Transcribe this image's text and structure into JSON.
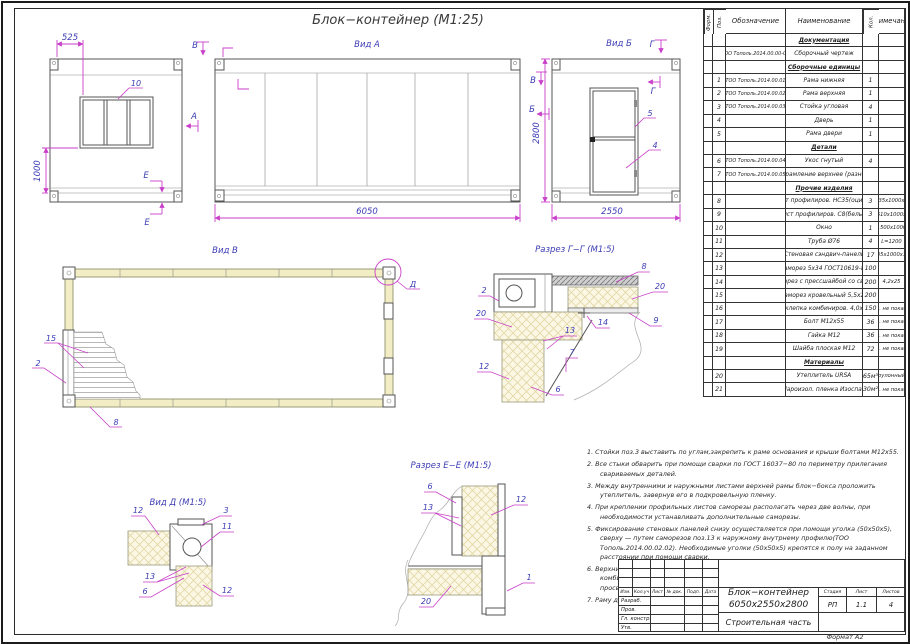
{
  "sheet": {
    "title": "Блок−контейнер  (М1:25)",
    "format": "Формат А2"
  },
  "colors": {
    "annotation_blue": "#3b3bb5",
    "dimension_magenta": "#c93fc9",
    "frame_khaki": "#f2edc4",
    "line_gray": "#555555"
  },
  "views": {
    "rear": {
      "dim_top": "525",
      "dim_left": "1000",
      "marker_top": "В",
      "marker_front": "А",
      "marker_e": "Е",
      "callouts": {
        "c10": "10"
      }
    },
    "front": {
      "title": "Вид А",
      "dim": "6050"
    },
    "end": {
      "title": "Вид Б",
      "dim_h": "2800",
      "dim_w": "2550",
      "marker_g": "Г",
      "marker_v": "В",
      "marker_b": "Б",
      "callouts": {
        "c5": "5",
        "c4": "4"
      }
    },
    "plan": {
      "title": "Вид В",
      "callouts": {
        "c15": "15",
        "c2": "2",
        "c8": "8",
        "d": "Д"
      }
    },
    "section_gg": {
      "title": "Разрез Г−Г (М1:5)",
      "callouts": {
        "c2": "2",
        "c20a": "20",
        "c8": "8",
        "c20b": "20",
        "c9": "9",
        "c14": "14",
        "c13": "13",
        "c7": "7",
        "c12": "12",
        "c6": "6"
      }
    },
    "view_d": {
      "title": "Вид Д (М1:5)",
      "callouts": {
        "c12a": "12",
        "c3": "3",
        "c11": "11",
        "c13": "13",
        "c6": "6",
        "c12b": "12"
      }
    },
    "section_ee": {
      "title": "Разрез Е−Е (М1:5)",
      "callouts": {
        "c6": "6",
        "c13": "13",
        "c12": "12",
        "c1": "1",
        "c20": "20"
      }
    }
  },
  "spec_table": {
    "headers": [
      "Форм.",
      "Поз.",
      "Обозначение",
      "Наименование",
      "Кол.",
      "Примечание"
    ],
    "rows": [
      {
        "section": "Документация"
      },
      {
        "form": "",
        "poz": "",
        "oboz": "ТОО Тополь.2014.00.00-СБ",
        "name": "Сборочный чертеж",
        "qty": "",
        "note": ""
      },
      {
        "section": "Сборочные единицы"
      },
      {
        "form": "",
        "poz": "1",
        "oboz": "ТОО Тополь.2014.00.01",
        "name": "Рама нижняя",
        "qty": "1",
        "note": ""
      },
      {
        "form": "",
        "poz": "2",
        "oboz": "ТОО Тополь.2014.00.02",
        "name": "Рама верхняя",
        "qty": "1",
        "note": ""
      },
      {
        "form": "",
        "poz": "3",
        "oboz": "ТОО Тополь.2014.00.03",
        "name": "Стойка угловая",
        "qty": "4",
        "note": ""
      },
      {
        "form": "",
        "poz": "4",
        "oboz": "",
        "name": "Дверь",
        "qty": "1",
        "note": ""
      },
      {
        "form": "",
        "poz": "5",
        "oboz": "",
        "name": "Рама двери",
        "qty": "1",
        "note": ""
      },
      {
        "section": "Детали"
      },
      {
        "form": "",
        "poz": "6",
        "oboz": "ТОО Тополь.2014.00.04",
        "name": "Укос гнутый",
        "qty": "4",
        "note": ""
      },
      {
        "form": "",
        "poz": "7",
        "oboz": "ТОО Тополь.2014.00.05",
        "name": "Обрамление верхнее (разное)",
        "qty": "",
        "note": ""
      },
      {
        "section": "Прочие изделия"
      },
      {
        "form": "",
        "poz": "8",
        "oboz": "",
        "name": "Лист профилиров. НС35(оцинк.)",
        "qty": "3",
        "note": "5935х1000х35"
      },
      {
        "form": "",
        "poz": "9",
        "oboz": "",
        "name": "Лист профилиров. С8(белый)",
        "qty": "3",
        "note": "5510х1000х8"
      },
      {
        "form": "",
        "poz": "10",
        "oboz": "",
        "name": "Окно",
        "qty": "1",
        "note": "1500х1000"
      },
      {
        "form": "",
        "poz": "11",
        "oboz": "",
        "name": "Труба Ø76",
        "qty": "4",
        "note": "L=1200"
      },
      {
        "form": "",
        "poz": "12",
        "oboz": "",
        "name": "Стеновая сэндвич-панель",
        "qty": "17",
        "note": "2435х1000х100"
      },
      {
        "form": "",
        "poz": "13",
        "oboz": "",
        "name": "Саморез 5х34 ГОСТ10619-80",
        "qty": "100",
        "note": ""
      },
      {
        "form": "",
        "poz": "14",
        "oboz": "",
        "name": "Саморез с прессшайбой со сверл.",
        "qty": "200",
        "note": "4,2х25"
      },
      {
        "form": "",
        "poz": "15",
        "oboz": "",
        "name": "Саморез кровельный 5,5х25",
        "qty": "200",
        "note": ""
      },
      {
        "form": "",
        "poz": "16",
        "oboz": "",
        "name": "Заклепка комбиниров. 4,0х12",
        "qty": "150",
        "note": "усл. не показан"
      },
      {
        "form": "",
        "poz": "17",
        "oboz": "",
        "name": "Болт М12х55",
        "qty": "36",
        "note": "усл. не показан"
      },
      {
        "form": "",
        "poz": "18",
        "oboz": "",
        "name": "Гайка М12",
        "qty": "36",
        "note": "усл. не показан"
      },
      {
        "form": "",
        "poz": "19",
        "oboz": "",
        "name": "Шайба плоская М12",
        "qty": "72",
        "note": "усл. не показан"
      },
      {
        "section": "Материалы"
      },
      {
        "form": "",
        "poz": "20",
        "oboz": "",
        "name": "Утеплитель URSA",
        "qty": "65м³",
        "note": "рулонный"
      },
      {
        "form": "",
        "poz": "21",
        "oboz": "",
        "name": "Пароизол. пленка Изоспан",
        "qty": "30м²",
        "note": "усл. не показан"
      }
    ]
  },
  "notes": [
    {
      "num": "1.",
      "text": "Стойки поз.3 выставить по углам,закрепить к раме основания и крыши болтами М12х55."
    },
    {
      "num": "2.",
      "text": "Все стыки обварить при помощи сварки по ГОСТ 16037−80 по периметру прилегания свариваемых деталей."
    },
    {
      "num": "3.",
      "text": "Между внутренними и наружными листами верхней рамы блок−бокса проложить утеплитель, завернув его в подкровельную пленку."
    },
    {
      "num": "4.",
      "text": "При креплении профильных листов саморезы располагать через две волны, при необходимости устанавливать дополнительные саморезы."
    },
    {
      "num": "5.",
      "text": "Фиксирование стеновых панелей снизу осуществляется при помощи уголка (50х50х5), сверху — путем саморезов поз.13 к наружному внутрнему профилю(ТОО Тополь.2014.00.02.02). Необходимые уголки (50х50х5) крепятся к полу на заданном расстоянии при помощи сварки."
    },
    {
      "num": "6.",
      "text": "Верхние и угловые стыки блоков закрыть соответ.обрамлением (поз 7), закрепив его комбинированными заклепками с шагом 300мм. Под заклепки предварительно просверлить отверстия Ø4,2мм"
    },
    {
      "num": "7.",
      "text": "Раму двери закрепить к нижней и верхней раме при помощи сварки."
    }
  ],
  "title_block": {
    "rev_headers": [
      "Изм.",
      "Кол.уч",
      "Лист",
      "№ док.",
      "Подп.",
      "Дата"
    ],
    "sign_labels": [
      "Разраб.",
      "Пров.",
      "Гл. констр.",
      "Утв."
    ],
    "doc1": "Блок−контейнер",
    "doc2": "6050х2550х2800",
    "stage_h": "Стадия",
    "list_h": "Лист",
    "listov_h": "Листов",
    "stage": "РП",
    "list": "1.1",
    "listov": "4",
    "part": "Строительная часть"
  }
}
